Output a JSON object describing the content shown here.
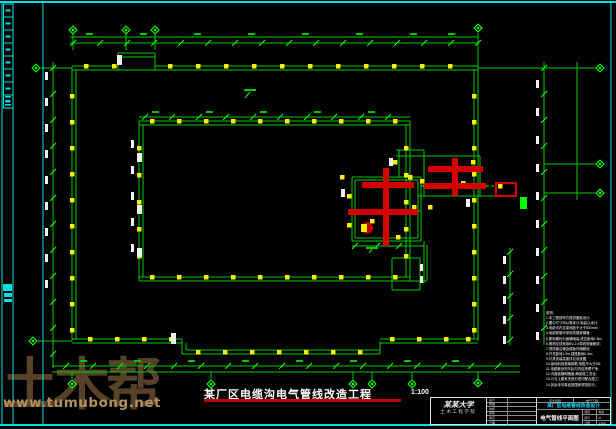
{
  "watermark": {
    "big_text": "土木帮",
    "url_text": "www.tumubong.net"
  },
  "colors": {
    "background": "#000000",
    "frame_cyan": "#00e0e0",
    "cad_green": "#00c800",
    "cad_bright_green": "#00ff00",
    "cad_yellow": "#ffee00",
    "cad_red": "#d40000",
    "dim_text_white": "#f0f0f0",
    "title_underline_red": "#c40000",
    "project_cyan": "#00dcff",
    "watermark_brown": "#b2905c"
  },
  "plan": {
    "title": "某厂区电缆沟电气管线改造工程",
    "scale": "1:100"
  },
  "notes": {
    "lines": [
      "说明:",
      "1.本工程按甲方提供图纸设计;",
      "2.图中尺寸均以毫米计,标高以米计;",
      "3.电缆沟内支架间距不大于800mm;",
      "4.电缆穿管均采用热镀锌钢管;",
      "5.配电箱均为嵌墙暗装,底边距地1.5m;",
      "6.照明支线采用BV-2.5导线穿管敷设;",
      "7.穿线管沿墙及楼板内暗敷设;",
      "8.开关距地1.3m,插座距地0.3m;",
      "9.灯具安装高度详见系统图;",
      "10.接地利用基础钢筋,电阻不大于4Ω;",
      "11.电缆敷设完毕后沟内应清理干净;",
      "12.沟盖板随砌随盖,确保施工安全;",
      "13.凡与土建有关部分密切配合施工;",
      "14.其余未尽事宜按国家规范执行。"
    ]
  },
  "titleblock": {
    "school_name": "某某大学",
    "school_dept": "土木工程学院",
    "rows": [
      {
        "label": "设计",
        "value": ""
      },
      {
        "label": "制图",
        "value": ""
      },
      {
        "label": "校核",
        "value": ""
      },
      {
        "label": "审核",
        "value": ""
      },
      {
        "label": "审定",
        "value": ""
      },
      {
        "label": "日期",
        "value": ""
      }
    ],
    "class_row": {
      "left": "专业班级",
      "right": "电气工程"
    },
    "project": "某厂区电缆管线改造设计",
    "drawing_title": "电气管线平面图",
    "mini": [
      {
        "label": "图别",
        "value": "电施"
      },
      {
        "label": "图号",
        "value": "01"
      },
      {
        "label": "比例",
        "value": "1:100"
      }
    ]
  }
}
